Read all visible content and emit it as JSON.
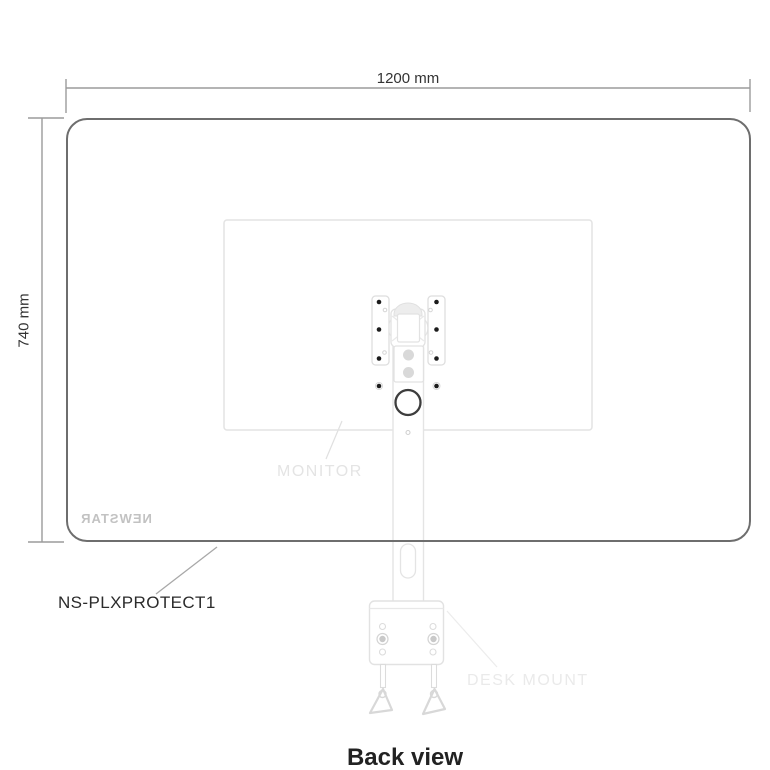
{
  "diagram": {
    "title": "Back view",
    "product_code": "NS-PLXPROTECT1",
    "brand": "NEWSTAR",
    "brand_mirrored": true,
    "dimensions": {
      "width_label": "1200 mm",
      "height_label": "740 mm"
    },
    "labels": {
      "monitor": "MONITOR",
      "desk_mount": "DESK MOUNT"
    },
    "parts": [
      "protective-cover",
      "monitor",
      "vesa-mount-plates",
      "mounting-pole",
      "tension-knob",
      "desk-mount-clamp",
      "toggle-anchors"
    ],
    "colors": {
      "background": "#ffffff",
      "panel_outline": "#6e6e6e",
      "dimension_line": "#9b9b9b",
      "light_outline": "#e2e2e2",
      "faint_label": "#e4e4e4",
      "dark_text": "#2b2b2b",
      "screw_hole": "#1c1c1c",
      "knob_ring": "#3d3d3d"
    }
  }
}
